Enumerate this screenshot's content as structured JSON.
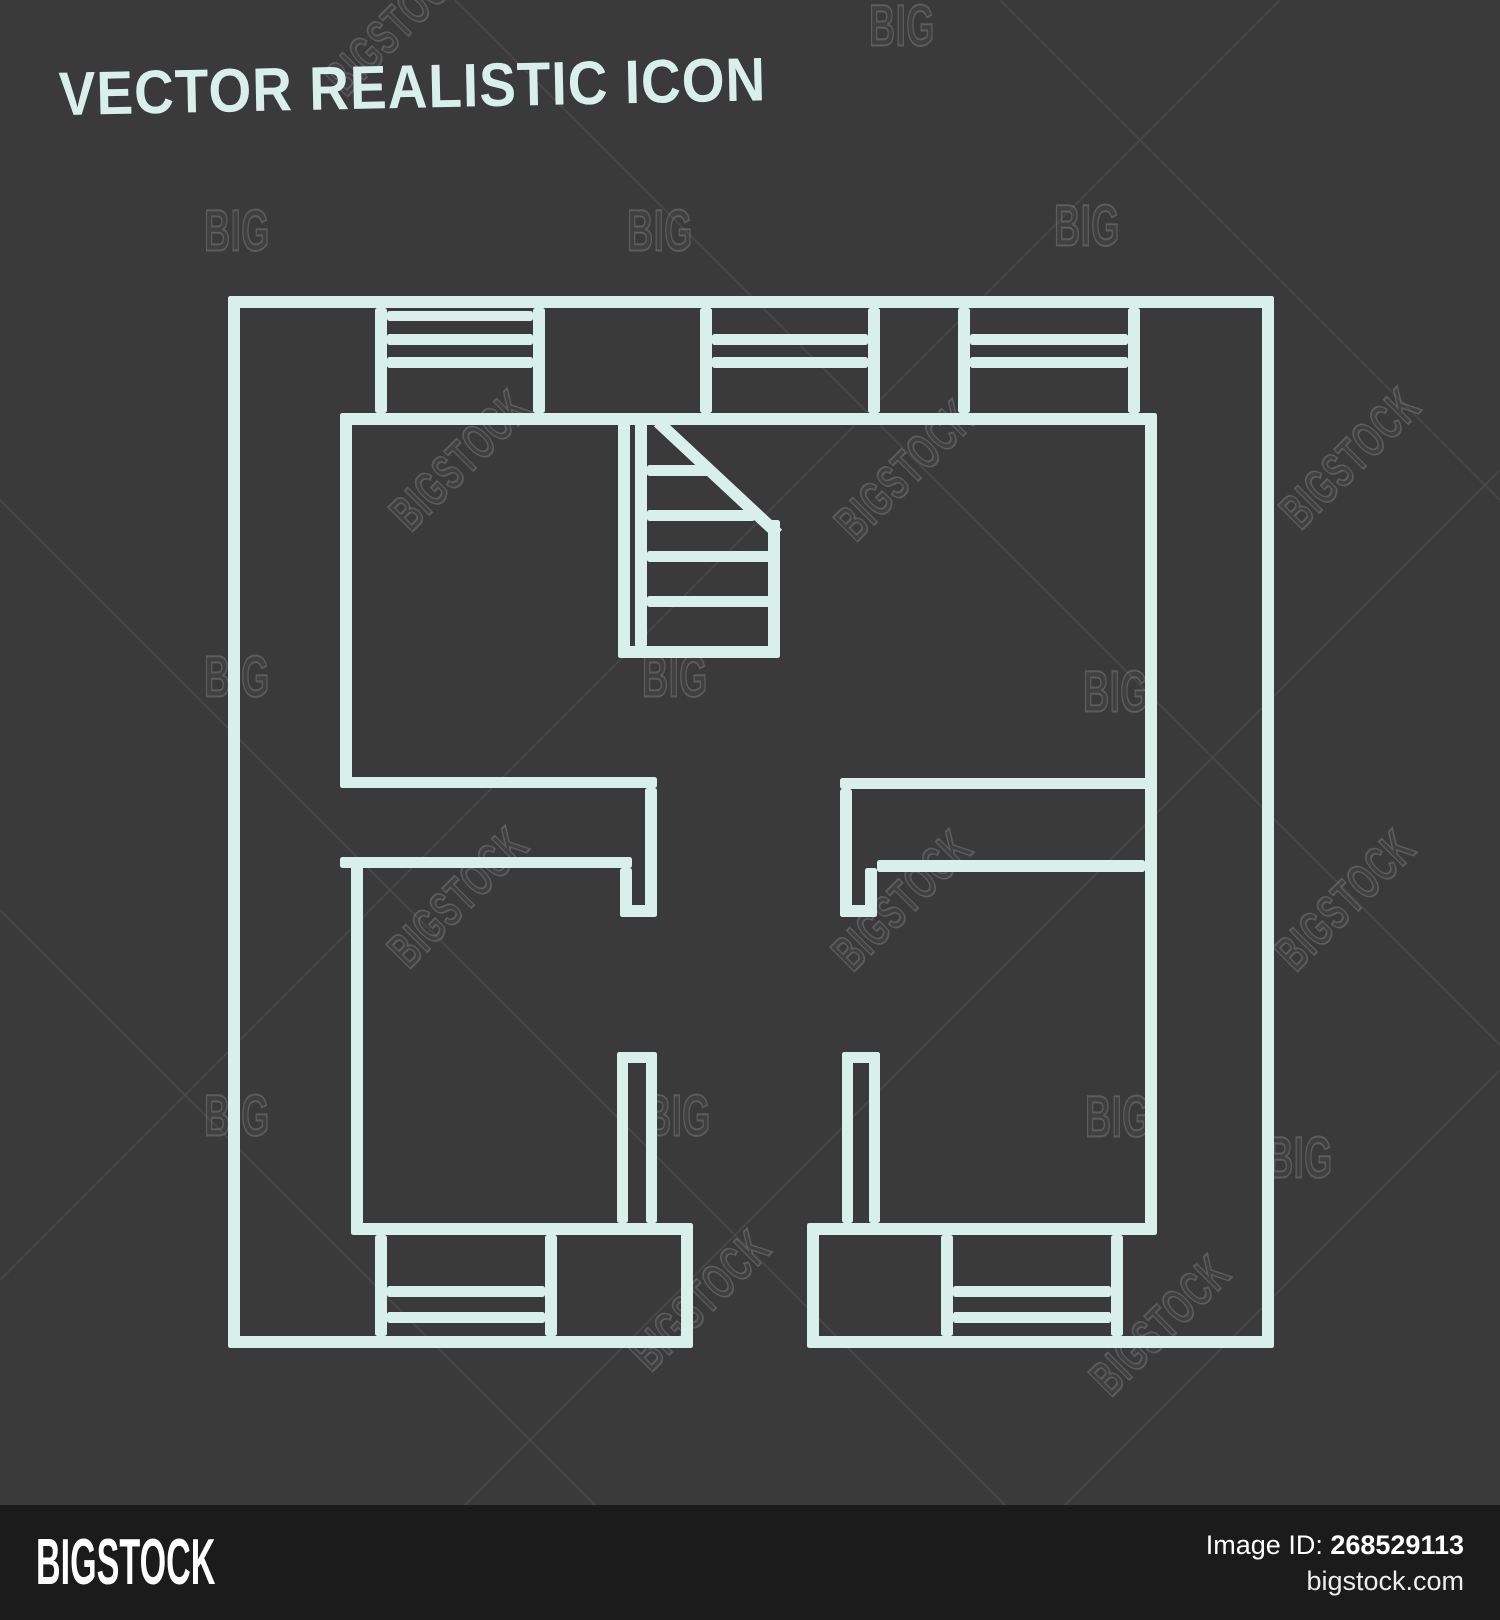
{
  "title": "VECTOR REALISTIC ICON",
  "colors": {
    "background": "#3a3a3a",
    "plan_line": "#d9f0ea",
    "footer_bg": "#1b1b1b",
    "footer_text": "#ffffff",
    "watermark_line": "#4d4d4d"
  },
  "watermark": {
    "big_text": "BIG",
    "bigstock_text": "BIGSTOCK",
    "big_positions": [
      [
        237,
        231
      ],
      [
        660,
        231
      ],
      [
        1087,
        226
      ],
      [
        902,
        26
      ],
      [
        237,
        677
      ],
      [
        675,
        677
      ],
      [
        1116,
        692
      ],
      [
        237,
        1116
      ],
      [
        678,
        1116
      ],
      [
        1118,
        1117
      ],
      [
        1300,
        1158
      ]
    ],
    "bigstock_positions": [
      [
        395,
        25
      ],
      [
        460,
        460
      ],
      [
        905,
        470
      ],
      [
        1350,
        458
      ],
      [
        458,
        897
      ],
      [
        902,
        900
      ],
      [
        1345,
        900
      ],
      [
        700,
        1300
      ],
      [
        1160,
        1325
      ]
    ],
    "diag_lines": [
      [
        -100,
        400,
        1200,
        1700
      ],
      [
        455,
        0,
        1500,
        1045
      ],
      [
        0,
        910,
        710,
        1620
      ],
      [
        1000,
        0,
        1500,
        500
      ],
      [
        0,
        1280,
        1280,
        0
      ],
      [
        350,
        1620,
        1500,
        470
      ],
      [
        950,
        1620,
        1500,
        1070
      ]
    ]
  },
  "floor_plan": {
    "rects": [
      [
        228,
        296,
        1046,
        12
      ],
      [
        228,
        296,
        12,
        1052
      ],
      [
        1262,
        296,
        12,
        1052
      ],
      [
        228,
        1336,
        465,
        12
      ],
      [
        807,
        1336,
        467,
        12
      ],
      [
        340,
        413,
        817,
        12
      ],
      [
        375,
        308,
        12,
        105
      ],
      [
        533,
        308,
        12,
        105
      ],
      [
        700,
        308,
        12,
        105
      ],
      [
        868,
        308,
        12,
        105
      ],
      [
        958,
        308,
        12,
        105
      ],
      [
        1128,
        308,
        12,
        105
      ],
      [
        387,
        311,
        146,
        10
      ],
      [
        387,
        334,
        146,
        11
      ],
      [
        387,
        357,
        146,
        11
      ],
      [
        712,
        334,
        156,
        11
      ],
      [
        712,
        357,
        156,
        11
      ],
      [
        970,
        334,
        158,
        11
      ],
      [
        970,
        357,
        158,
        11
      ],
      [
        340,
        413,
        12,
        375
      ],
      [
        340,
        777,
        317,
        11
      ],
      [
        340,
        857,
        292,
        11
      ],
      [
        645,
        788,
        12,
        129
      ],
      [
        620,
        905,
        37,
        12
      ],
      [
        620,
        868,
        12,
        49
      ],
      [
        351,
        857,
        12,
        378
      ],
      [
        351,
        1223,
        342,
        12
      ],
      [
        617,
        1052,
        40,
        11
      ],
      [
        617,
        1052,
        11,
        171
      ],
      [
        646,
        1052,
        11,
        171
      ],
      [
        375,
        1235,
        12,
        101
      ],
      [
        545,
        1235,
        12,
        101
      ],
      [
        387,
        1286,
        158,
        11
      ],
      [
        387,
        1312,
        158,
        11
      ],
      [
        681,
        1223,
        12,
        125
      ],
      [
        840,
        778,
        317,
        11
      ],
      [
        1145,
        413,
        12,
        822
      ],
      [
        840,
        789,
        12,
        128
      ],
      [
        840,
        905,
        37,
        12
      ],
      [
        865,
        868,
        12,
        49
      ],
      [
        877,
        860,
        268,
        12
      ],
      [
        807,
        1223,
        350,
        12
      ],
      [
        842,
        1052,
        38,
        11
      ],
      [
        842,
        1052,
        11,
        171
      ],
      [
        869,
        1052,
        11,
        171
      ],
      [
        807,
        1223,
        12,
        125
      ],
      [
        941,
        1235,
        12,
        101
      ],
      [
        1111,
        1235,
        12,
        101
      ],
      [
        953,
        1286,
        158,
        11
      ],
      [
        953,
        1312,
        158,
        11
      ],
      [
        618,
        423,
        12,
        235
      ],
      [
        635,
        423,
        12,
        224
      ],
      [
        618,
        646,
        162,
        12
      ],
      [
        647,
        465,
        66,
        11
      ],
      [
        647,
        510,
        108,
        11
      ],
      [
        647,
        551,
        133,
        11
      ],
      [
        647,
        596,
        133,
        11
      ],
      [
        768,
        520,
        12,
        138
      ]
    ],
    "diagonal": [
      658,
      422,
      778,
      534
    ]
  },
  "footer": {
    "logo": "BIGSTOCK",
    "image_id_label": "Image ID:",
    "image_id": "268529113",
    "site": "bigstock.com"
  }
}
